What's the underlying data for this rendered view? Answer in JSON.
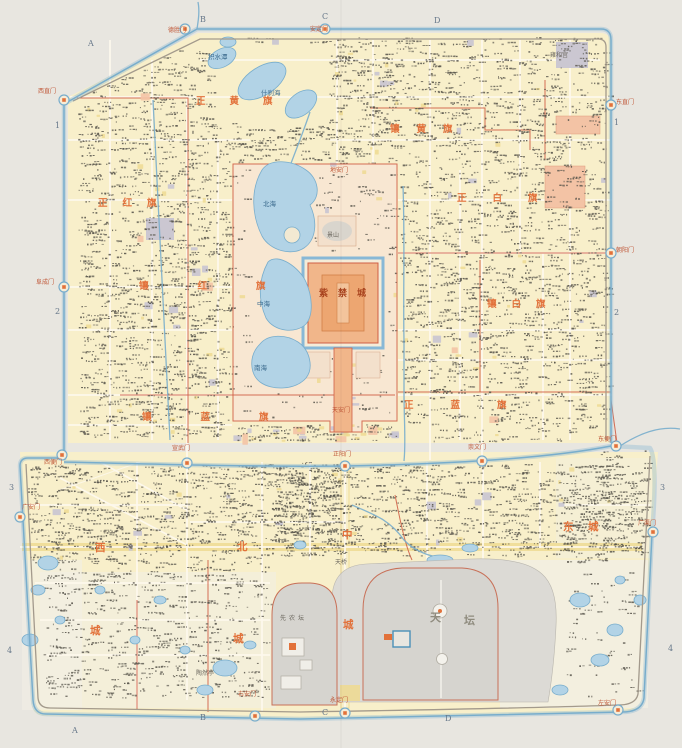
{
  "map": {
    "kind": "historical city map of Beijing (inner and outer city), scanned atlas sheet",
    "grid_labels": [
      {
        "t": "A",
        "x": 88,
        "y": 46
      },
      {
        "t": "B",
        "x": 200,
        "y": 22
      },
      {
        "t": "C",
        "x": 322,
        "y": 19
      },
      {
        "t": "D",
        "x": 434,
        "y": 23
      },
      {
        "t": "A",
        "x": 72,
        "y": 733
      },
      {
        "t": "B",
        "x": 200,
        "y": 720
      },
      {
        "t": "C",
        "x": 322,
        "y": 715
      },
      {
        "t": "D",
        "x": 445,
        "y": 721
      },
      {
        "t": "1",
        "x": 55,
        "y": 128
      },
      {
        "t": "2",
        "x": 55,
        "y": 314
      },
      {
        "t": "3",
        "x": 9,
        "y": 490
      },
      {
        "t": "4",
        "x": 7,
        "y": 653
      },
      {
        "t": "1",
        "x": 614,
        "y": 125
      },
      {
        "t": "2",
        "x": 614,
        "y": 315
      },
      {
        "t": "3",
        "x": 660,
        "y": 490
      },
      {
        "t": "4",
        "x": 668,
        "y": 651
      }
    ],
    "labels": [
      {
        "t": "正黄旗",
        "x": 196,
        "y": 104,
        "c": "banner",
        "ls": 24
      },
      {
        "t": "镶黄旗",
        "x": 390,
        "y": 132,
        "c": "banner",
        "ls": 17
      },
      {
        "t": "正白旗",
        "x": 457,
        "y": 201,
        "c": "banner",
        "ls": 26
      },
      {
        "t": "镶白旗",
        "x": 487,
        "y": 307,
        "c": "banner",
        "ls": 15
      },
      {
        "t": "正红旗",
        "x": 98,
        "y": 206,
        "c": "banner",
        "ls": 15
      },
      {
        "t": "镶红旗",
        "x": 139,
        "y": 289,
        "c": "banner",
        "ls": 49
      },
      {
        "t": "镶蓝旗",
        "x": 142,
        "y": 420,
        "c": "banner",
        "ls": 49
      },
      {
        "t": "正蓝旗",
        "x": 404,
        "y": 408,
        "c": "banner",
        "ls": 37
      },
      {
        "t": "西",
        "x": 95,
        "y": 551,
        "c": "district"
      },
      {
        "t": "城",
        "x": 90,
        "y": 634,
        "c": "district"
      },
      {
        "t": "北",
        "x": 237,
        "y": 550,
        "c": "district"
      },
      {
        "t": "城",
        "x": 233,
        "y": 642,
        "c": "district"
      },
      {
        "t": "中",
        "x": 342,
        "y": 538,
        "c": "district"
      },
      {
        "t": "城",
        "x": 343,
        "y": 628,
        "c": "district"
      },
      {
        "t": "东",
        "x": 563,
        "y": 530,
        "c": "district"
      },
      {
        "t": "城",
        "x": 588,
        "y": 530,
        "c": "district"
      },
      {
        "t": "紫禁城",
        "x": 319,
        "y": 296,
        "c": "palace",
        "ls": 10
      },
      {
        "t": "景山",
        "x": 327,
        "y": 237,
        "c": "geo"
      },
      {
        "t": "北海",
        "x": 263,
        "y": 206,
        "c": "water-name"
      },
      {
        "t": "中海",
        "x": 257,
        "y": 306,
        "c": "water-name"
      },
      {
        "t": "南海",
        "x": 254,
        "y": 370,
        "c": "water-name"
      },
      {
        "t": "什刹海",
        "x": 261,
        "y": 95,
        "c": "water-name"
      },
      {
        "t": "积水潭",
        "x": 208,
        "y": 59,
        "c": "water-name"
      },
      {
        "t": "天",
        "x": 430,
        "y": 621,
        "c": "altar-big"
      },
      {
        "t": "坛",
        "x": 464,
        "y": 624,
        "c": "altar-big"
      },
      {
        "t": "先农坛",
        "x": 280,
        "y": 620,
        "c": "geo",
        "ls": 3
      },
      {
        "t": "天桥",
        "x": 335,
        "y": 564,
        "c": "geo"
      },
      {
        "t": "陶然亭",
        "x": 196,
        "y": 675,
        "c": "geo"
      },
      {
        "t": "雍和宫",
        "x": 550,
        "y": 57,
        "c": "geo"
      },
      {
        "t": "德胜门",
        "x": 168,
        "y": 32,
        "c": "gate"
      },
      {
        "t": "安定门",
        "x": 310,
        "y": 31,
        "c": "gate"
      },
      {
        "t": "西直门",
        "x": 38,
        "y": 93,
        "c": "gate"
      },
      {
        "t": "阜成门",
        "x": 36,
        "y": 284,
        "c": "gate"
      },
      {
        "t": "东直门",
        "x": 616,
        "y": 104,
        "c": "gate"
      },
      {
        "t": "朝阳门",
        "x": 616,
        "y": 252,
        "c": "gate"
      },
      {
        "t": "宣武门",
        "x": 172,
        "y": 450,
        "c": "gate"
      },
      {
        "t": "正阳门",
        "x": 333,
        "y": 456,
        "c": "gate"
      },
      {
        "t": "崇文门",
        "x": 468,
        "y": 449,
        "c": "gate"
      },
      {
        "t": "西便门",
        "x": 44,
        "y": 464,
        "c": "gate"
      },
      {
        "t": "东便门",
        "x": 598,
        "y": 441,
        "c": "gate"
      },
      {
        "t": "广安门",
        "x": 22,
        "y": 509,
        "c": "gate"
      },
      {
        "t": "广渠门",
        "x": 638,
        "y": 525,
        "c": "gate"
      },
      {
        "t": "右安门",
        "x": 238,
        "y": 696,
        "c": "gate"
      },
      {
        "t": "永定门",
        "x": 330,
        "y": 702,
        "c": "gate"
      },
      {
        "t": "左安门",
        "x": 598,
        "y": 705,
        "c": "gate"
      },
      {
        "t": "天安门",
        "x": 332,
        "y": 412,
        "c": "gate"
      },
      {
        "t": "地安门",
        "x": 330,
        "y": 172,
        "c": "gate"
      }
    ],
    "colors": {
      "paper": "#e8e6e0",
      "city": "#f8efca",
      "city_light": "#f3efdd",
      "water": "#b2d3e6",
      "water_line": "#78adcc",
      "imperial": "#f8e7d2",
      "palace": "#f1b68a",
      "palace_core": "#eda671",
      "wall_red": "#cf5f46",
      "banner": "#e2713a",
      "gray_zone": "#dcdad5",
      "gray_inner": "#d6d4cf",
      "lavender": "#c8c4d1",
      "salmon": "#f3c3a5",
      "street": "#fdf8ec",
      "street_yellow": "#eed98f",
      "ink": "#56534a",
      "water_label": "#3c6b8e",
      "gate": "#c05838",
      "grid": "#67788a",
      "palace_label": "#a9441f"
    }
  }
}
